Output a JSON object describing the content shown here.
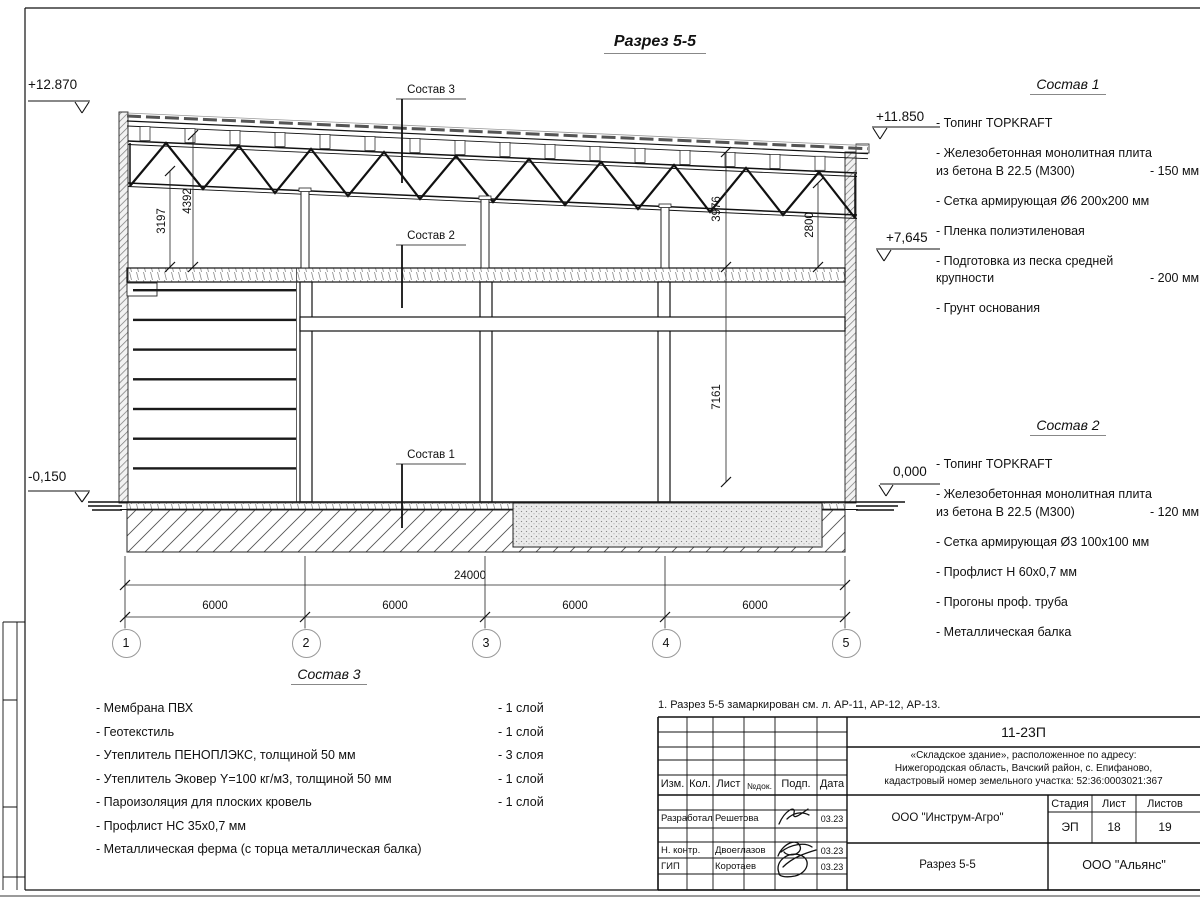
{
  "title": "Разрез 5-5",
  "note": "1. Разрез 5-5 замаркирован см. л. АР-11, АР-12, АР-13.",
  "elevations": {
    "top_left": "+12.870",
    "bottom_left": "-0,150",
    "top_right": "+11.850",
    "mid_right": "+7,645",
    "zero_right": "0,000"
  },
  "callouts": {
    "s1": "Состав 1",
    "s2": "Состав 2",
    "s3": "Состав 3"
  },
  "dims": {
    "total": "24000",
    "bay1": "6000",
    "bay2": "6000",
    "bay3": "6000",
    "bay4": "6000",
    "v1": "3197",
    "v2": "4392",
    "v3": "3976",
    "v4": "2800",
    "v5": "7161"
  },
  "axes": {
    "a1": "1",
    "a2": "2",
    "a3": "3",
    "a4": "4",
    "a5": "5"
  },
  "composition1": {
    "heading": "Состав 1",
    "items": [
      {
        "text": "- Топинг TOPKRAFT",
        "text2": "",
        "note": ""
      },
      {
        "text": "- Железобетонная  монолитная плита",
        "text2": "из бетона  В 22.5 (М300)",
        "note": "- 150 мм"
      },
      {
        "text": "- Сетка армирующая Ø6 200х200 мм",
        "text2": "",
        "note": ""
      },
      {
        "text": "- Пленка полиэтиленовая",
        "text2": "",
        "note": ""
      },
      {
        "text": "- Подготовка из песка средней",
        "text2": "крупности",
        "note": "- 200 мм"
      },
      {
        "text": "- Грунт основания",
        "text2": "",
        "note": ""
      }
    ]
  },
  "composition2": {
    "heading": "Состав 2",
    "items": [
      {
        "text": "- Топинг TOPKRAFT",
        "text2": "",
        "note": ""
      },
      {
        "text": "- Железобетонная  монолитная плита",
        "text2": "из бетона  В 22.5 (М300)",
        "note": "- 120 мм"
      },
      {
        "text": "- Сетка армирующая Ø3 100х100 мм",
        "text2": "",
        "note": ""
      },
      {
        "text": "- Профлист Н 60х0,7 мм",
        "text2": "",
        "note": ""
      },
      {
        "text": "- Прогоны проф. труба",
        "text2": "",
        "note": ""
      },
      {
        "text": "- Металлическая балка",
        "text2": "",
        "note": ""
      }
    ]
  },
  "composition3": {
    "heading": "Состав 3",
    "items": [
      {
        "text": "- Мембрана ПВХ",
        "note": "- 1 слой"
      },
      {
        "text": "- Геотекстиль",
        "note": "- 1 слой"
      },
      {
        "text": "- Утеплитель ПЕНОПЛЭКС, толщиной 50 мм",
        "note": "- 3 слоя"
      },
      {
        "text": "- Утеплитель Эковер Y=100 кг/м3, толщиной 50 мм",
        "note": "- 1 слой"
      },
      {
        "text": "- Пароизоляция для плоских кровель",
        "note": "- 1 слой"
      },
      {
        "text": "- Профлист НС 35х0,7 мм",
        "note": ""
      },
      {
        "text": "- Металлическая ферма (с торца металлическая балка)",
        "note": ""
      }
    ]
  },
  "stamp": {
    "doc_number": "11-23П",
    "project_line1": "«Складское здание», расположенное по адресу:",
    "project_line2": "Нижегородская область, Вачский район, с. Епифаново,",
    "project_line3": "кадастровый номер земельного участка: 52:36:0003021:367",
    "header": {
      "izm": "Изм.",
      "kol": "Кол.",
      "list": "Лист",
      "ndok": "№док.",
      "podp": "Подп.",
      "data": "Дата"
    },
    "rows": [
      {
        "role": "Разработал",
        "name": "Решетова",
        "date": "03.23"
      },
      {
        "role": "Н. контр.",
        "name": "Двоеглазов",
        "date": "03.23"
      },
      {
        "role": "ГИП",
        "name": "Коротаев",
        "date": "03.23"
      }
    ],
    "org_design": "ООО \"Инструм-Агро\"",
    "stage_label": "Стадия",
    "sheet_label": "Лист",
    "sheets_label": "Листов",
    "stage": "ЭП",
    "sheet": "18",
    "sheets": "19",
    "drawing_name": "Разрез 5-5",
    "org_customer": "ООО \"Альянс\""
  }
}
